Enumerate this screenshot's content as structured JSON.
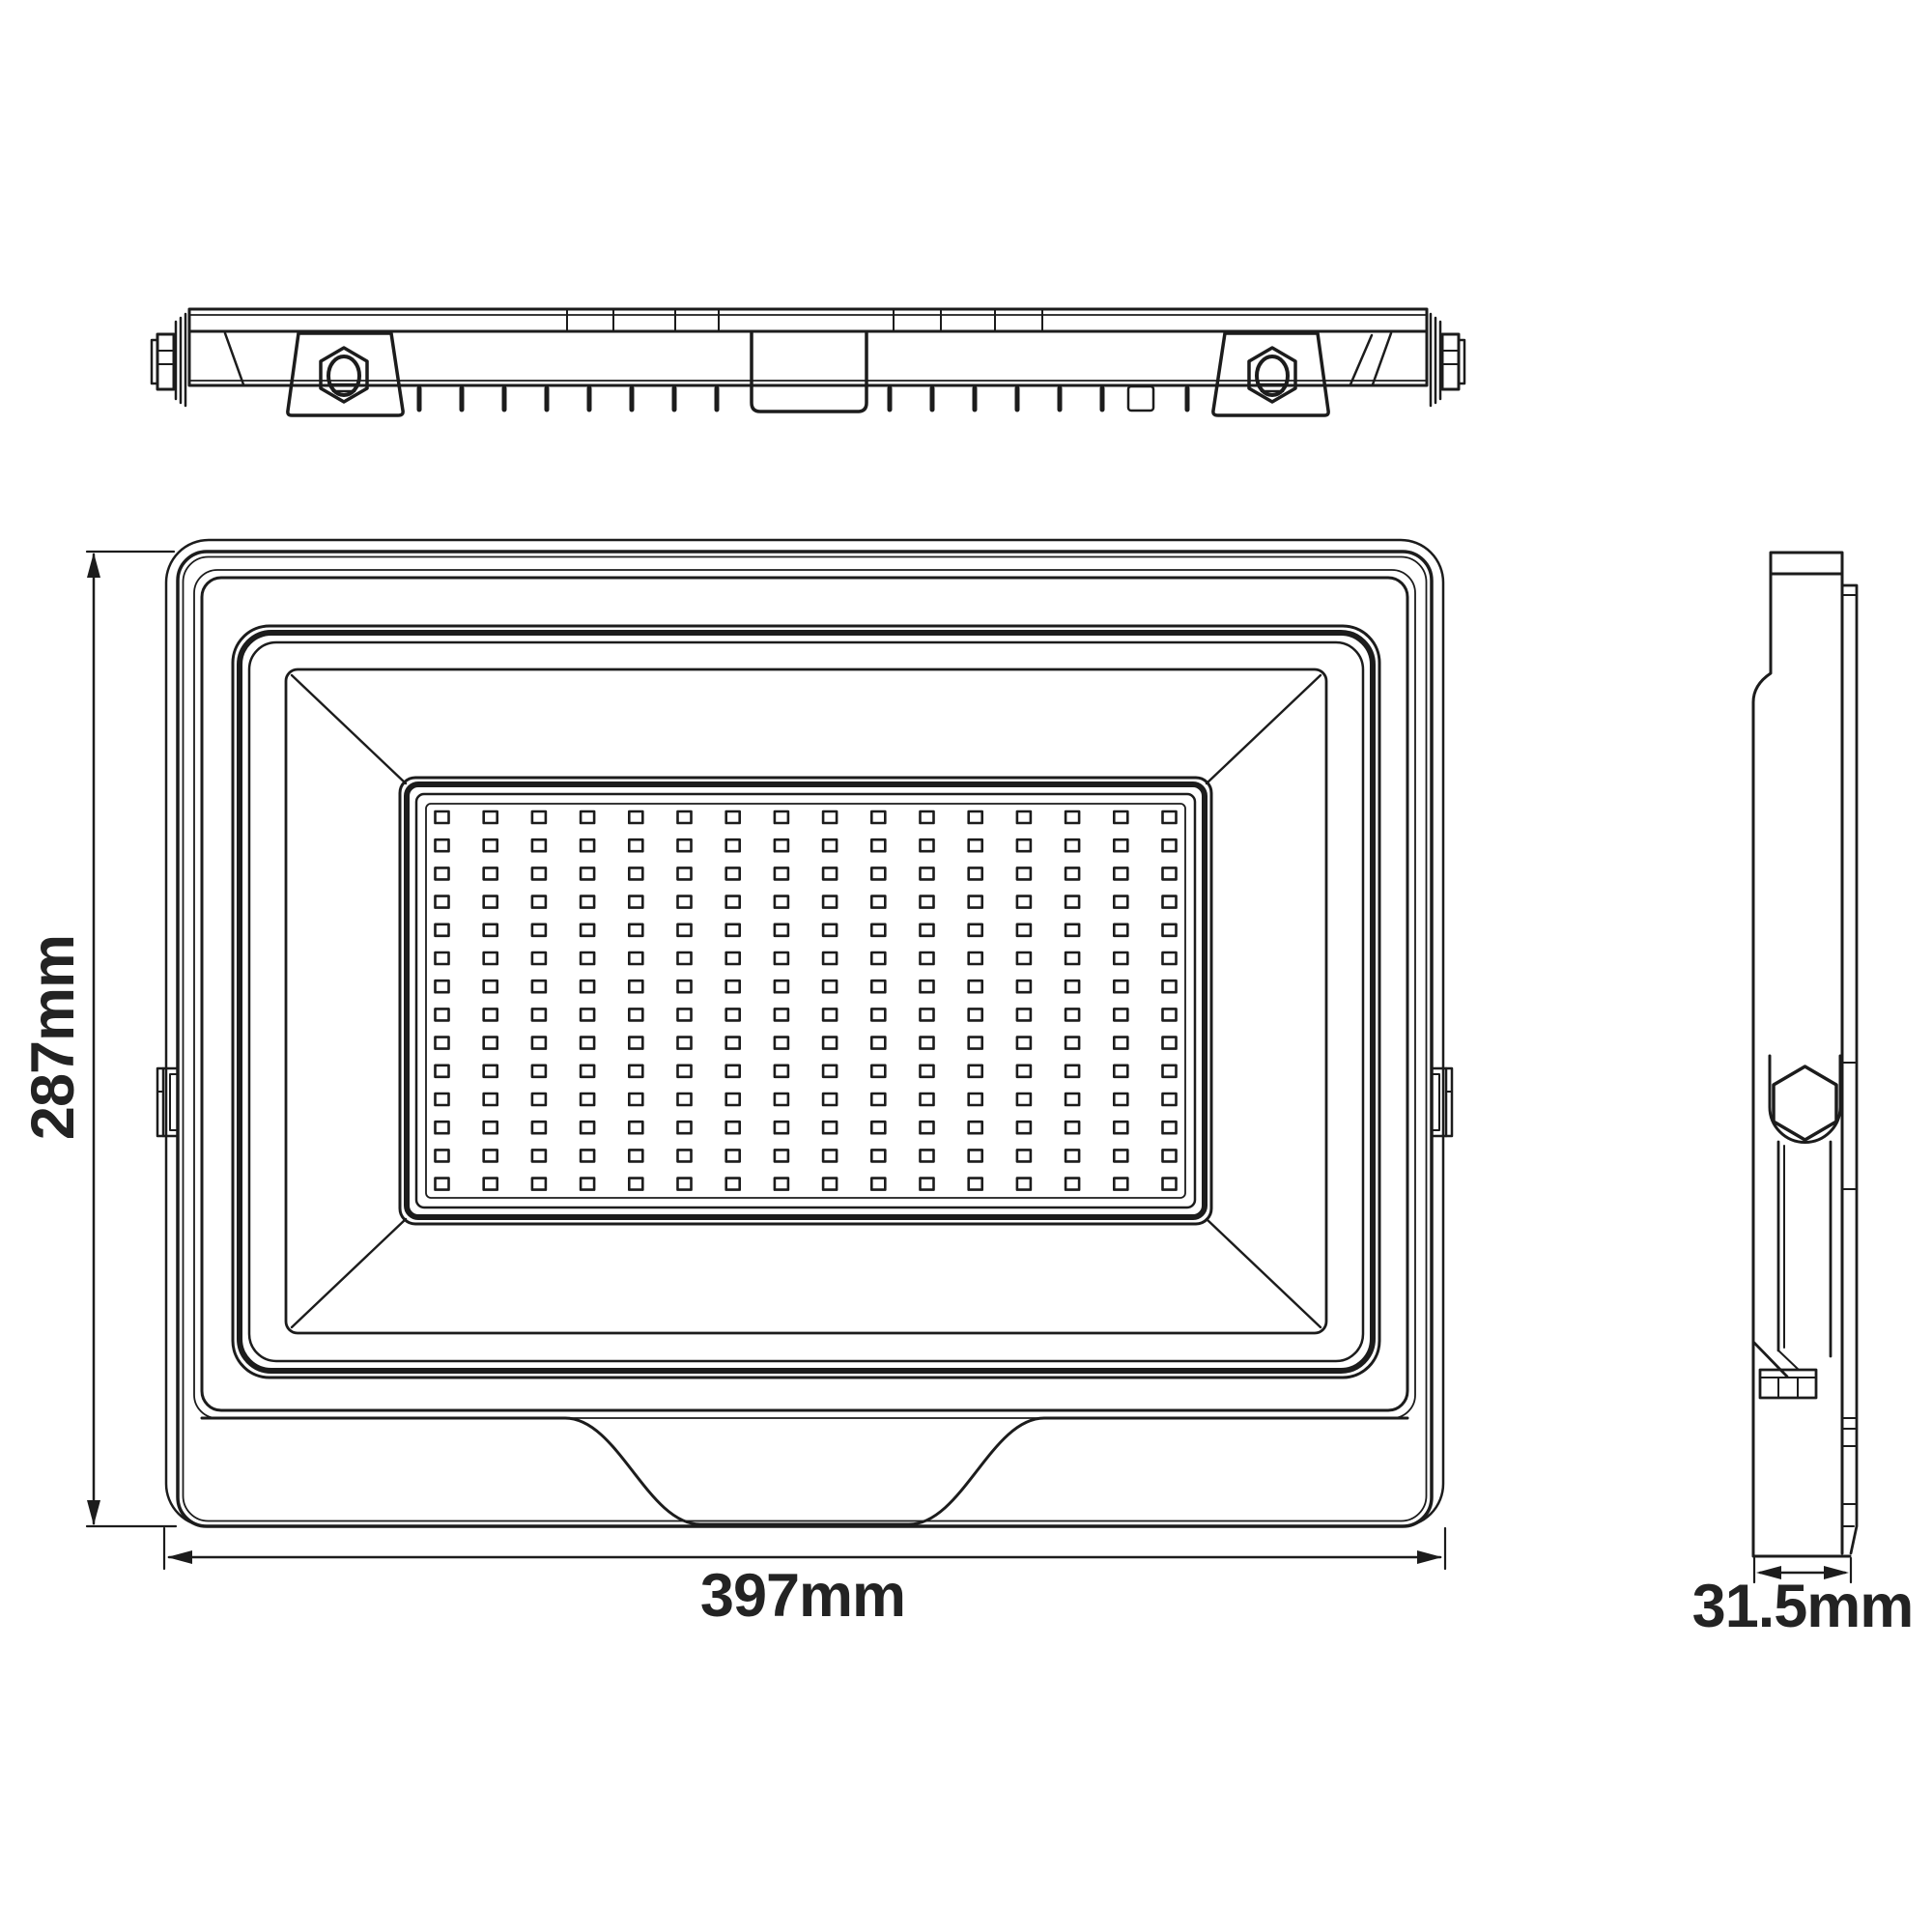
{
  "dimensions": {
    "height_label": "287mm",
    "width_label": "397mm",
    "depth_label": "31.5mm"
  },
  "led_grid": {
    "columns": 16,
    "rows": 14
  },
  "colors": {
    "line": "#1c1c1c",
    "text": "#232323",
    "background": "#ffffff"
  }
}
